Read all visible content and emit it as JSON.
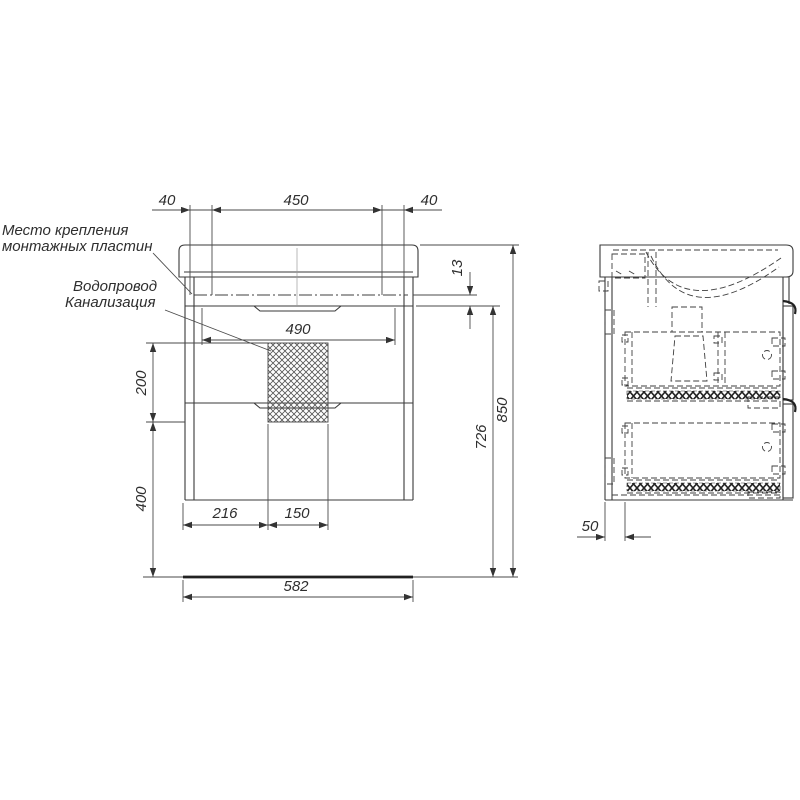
{
  "drawing": {
    "title": "vanity-cabinet-technical-drawing",
    "labels": {
      "mounting_line1": "Место крепления",
      "mounting_line2": "монтажных пластин",
      "water_supply": "Водопровод",
      "sewerage": "Канализация"
    },
    "dimensions": {
      "top_left_offset": "40",
      "top_center_span": "450",
      "top_right_offset": "40",
      "top_inset": "13",
      "inner_width": "490",
      "service_zone_height": "200",
      "lower_zone_height": "400",
      "drain_offset_left": "216",
      "drain_zone_width": "150",
      "overall_width": "582",
      "mounting_height": "726",
      "overall_height": "850",
      "back_clearance": "50"
    },
    "colors": {
      "line": "#3a3a3a",
      "dimension_line": "#4a4a4a",
      "background": "#ffffff"
    }
  }
}
